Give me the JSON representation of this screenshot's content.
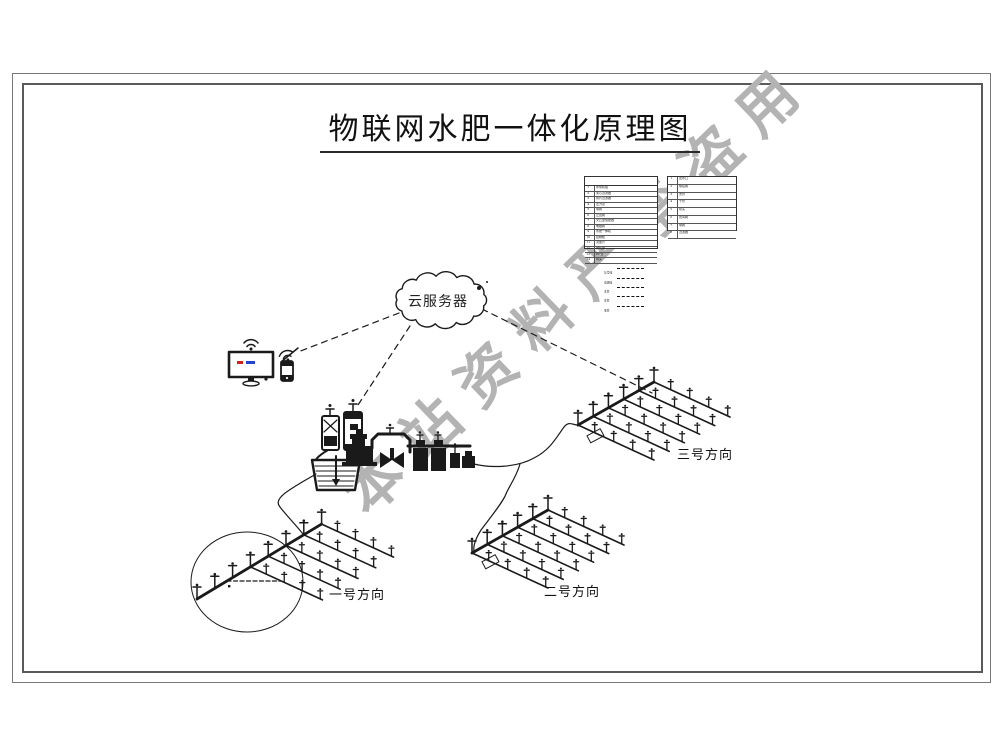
{
  "doc": {
    "title": "物联网水肥一体化原理图"
  },
  "watermark": {
    "text": "本站资料严禁盗用",
    "color": "#b3b3b3"
  },
  "cloud": {
    "label": "云服务器"
  },
  "fields": {
    "f1": {
      "label": "一号方向"
    },
    "f2": {
      "label": "二号方向"
    },
    "f3": {
      "label": "三号方向"
    }
  },
  "legend": {
    "main_table": {
      "header": "图例",
      "rows": [
        {
          "no": "1",
          "name": "水泵机组"
        },
        {
          "no": "2",
          "name": "离心过滤器"
        },
        {
          "no": "3",
          "name": "叠片过滤器"
        },
        {
          "no": "4",
          "name": "压力表"
        },
        {
          "no": "5",
          "name": "球阀"
        },
        {
          "no": "6",
          "name": "止回阀"
        },
        {
          "no": "7",
          "name": "文丘里施肥器"
        },
        {
          "no": "8",
          "name": "电磁阀"
        },
        {
          "no": "9",
          "name": "水肥一体机"
        },
        {
          "no": "10",
          "name": "控制柜"
        },
        {
          "no": "11",
          "name": "流量计"
        },
        {
          "no": "12",
          "name": "排气阀"
        },
        {
          "no": "13",
          "name": "PE管"
        },
        {
          "no": "14",
          "name": "喷头"
        }
      ]
    },
    "side_table": {
      "rows": [
        {
          "no": "1",
          "name": "出水口"
        },
        {
          "no": "2",
          "name": "快接阀"
        },
        {
          "no": "3",
          "name": "支管"
        },
        {
          "no": "4",
          "name": "干管"
        },
        {
          "no": "5",
          "name": "喷头"
        },
        {
          "no": "6",
          "name": "田间阀"
        },
        {
          "no": "7",
          "name": "球阀"
        },
        {
          "no": "8",
          "name": "过滤器"
        }
      ]
    },
    "line_types": [
      {
        "label": "信号线"
      },
      {
        "label": "电源线"
      },
      {
        "label": "主管"
      },
      {
        "label": "支管"
      },
      {
        "label": "毛管"
      }
    ]
  },
  "colors": {
    "ink": "#1a1a1a",
    "watermark": "#b3b3b3",
    "screen_red": "#cc2222",
    "screen_blue": "#2244cc"
  }
}
